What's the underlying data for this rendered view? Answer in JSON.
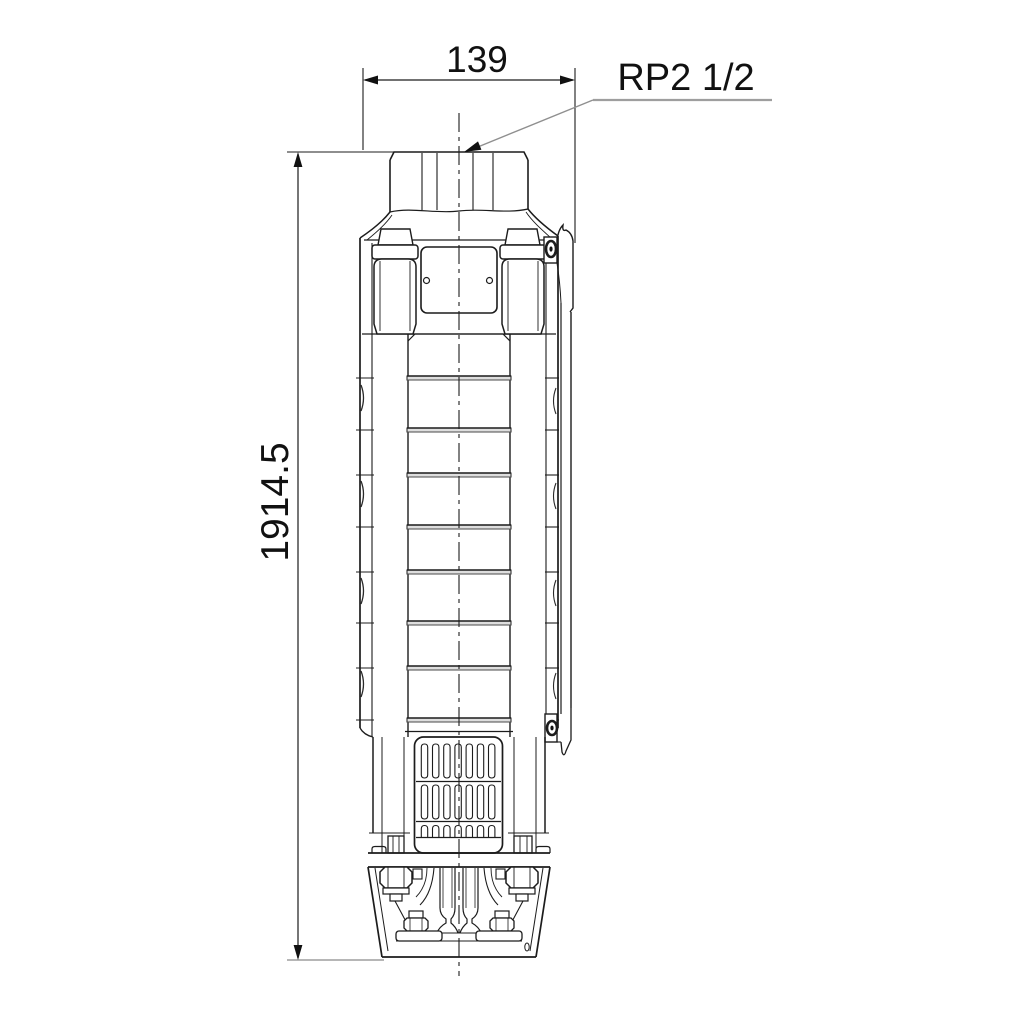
{
  "drawing": {
    "type": "technical dimensional drawing",
    "view": "submersible borehole pump, side elevation",
    "labels": {
      "width_dimension": "139",
      "height_dimension": "1914.5",
      "connection": "RP2 1/2"
    },
    "colors": {
      "line": "#1c1c1c",
      "leader": "#9e9e9e",
      "joint_fill": "#dedede",
      "background": "#ffffff",
      "text": "#111111"
    },
    "parts": [
      "discharge-connector-thread",
      "pump-head",
      "nameplate",
      "cable-guard",
      "chamber-stack",
      "suction-strainer",
      "motor-bracket"
    ]
  }
}
